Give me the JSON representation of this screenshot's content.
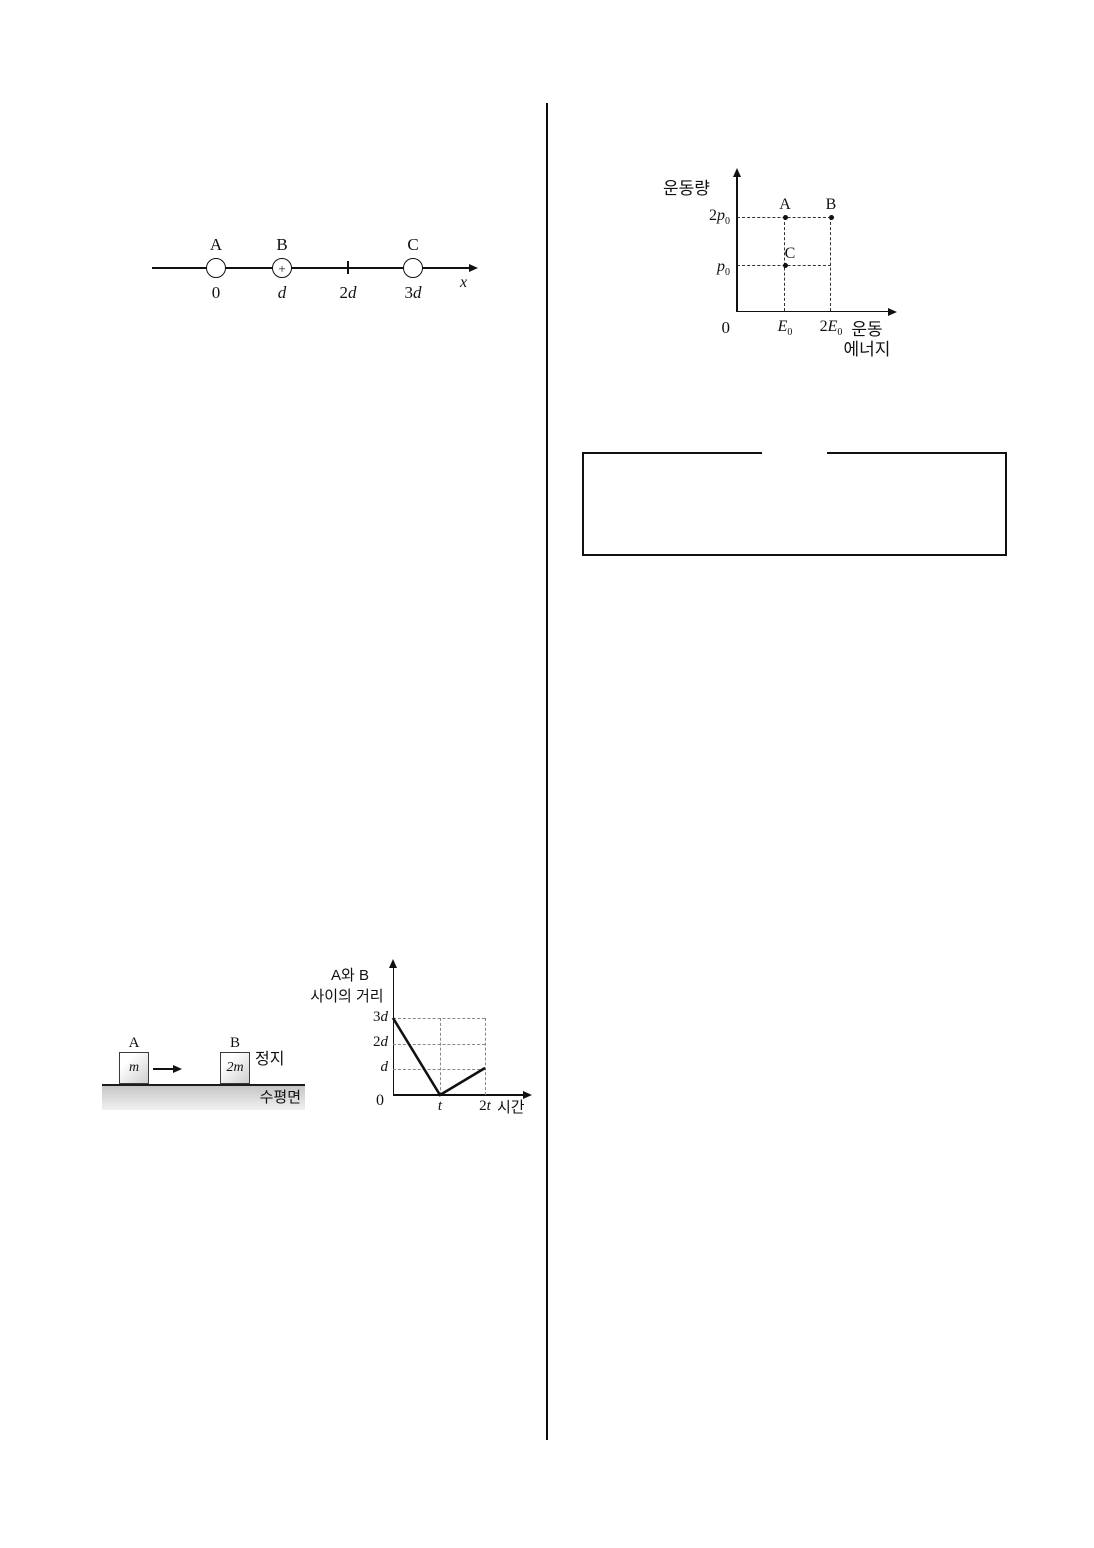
{
  "page": {
    "background": "#ffffff",
    "ink": "#111111"
  },
  "figure_charges": {
    "axis_label": "x",
    "charge_labels": [
      "A",
      "B",
      "C"
    ],
    "charge_b_sign": "+",
    "position_labels": [
      {
        "coef": "0",
        "var": ""
      },
      {
        "coef": "",
        "var": "d"
      },
      {
        "coef": "2",
        "var": "d"
      },
      {
        "coef": "3",
        "var": "d"
      }
    ]
  },
  "figure_momentum": {
    "y_axis_title": "운동량",
    "x_axis_title_line1": "운동",
    "x_axis_title_line2": "에너지",
    "origin_label": "0",
    "y_ticks": [
      {
        "coef": "2",
        "var": "p",
        "sub": "0"
      },
      {
        "coef": "",
        "var": "p",
        "sub": "0"
      }
    ],
    "x_ticks": [
      {
        "coef": "",
        "var": "E",
        "sub": "0"
      },
      {
        "coef": "2",
        "var": "E",
        "sub": "0"
      }
    ],
    "point_labels": [
      "A",
      "B",
      "C"
    ]
  },
  "figure_blocks": {
    "block_a": {
      "label": "A",
      "mass": "m"
    },
    "block_b": {
      "label": "B",
      "mass": "2m"
    },
    "rest_text": "정지",
    "surface_text": "수평면",
    "surface_color_top": "#c6c6c6",
    "surface_color_bottom": "#f0f0f0"
  },
  "figure_distance": {
    "y_axis_title_line1": "A와 B",
    "y_axis_title_line2": "사이의 거리",
    "origin_label": "0",
    "y_ticks": [
      {
        "coef": "3",
        "var": "d"
      },
      {
        "coef": "2",
        "var": "d"
      },
      {
        "coef": "",
        "var": "d"
      }
    ],
    "x_ticks": [
      {
        "coef": "",
        "var": "t"
      },
      {
        "coef": "2",
        "var": "t"
      }
    ],
    "x_axis_title": "시간"
  },
  "chart_data": [
    {
      "type": "scatter",
      "title": "momentum vs kinetic energy points A, B, C",
      "xlabel": "운동 에너지",
      "ylabel": "운동량",
      "x_tick_labels": [
        "0",
        "E0",
        "2E0"
      ],
      "y_tick_labels": [
        "p0",
        "2p0"
      ],
      "points": [
        {
          "label": "A",
          "x": "E0",
          "y": "2p0"
        },
        {
          "label": "B",
          "x": "2E0",
          "y": "2p0"
        },
        {
          "label": "C",
          "x": "E0",
          "y": "p0"
        }
      ],
      "grid": "dashed guide lines from axes to points",
      "legend": "none"
    },
    {
      "type": "line",
      "title": "distance between A and B vs time",
      "xlabel": "시간",
      "ylabel": "A와 B 사이의 거리",
      "x_tick_labels": [
        "0",
        "t",
        "2t"
      ],
      "y_tick_labels": [
        "d",
        "2d",
        "3d"
      ],
      "points": [
        {
          "x": "0",
          "y": "3d"
        },
        {
          "x": "t",
          "y": "0"
        },
        {
          "x": "2t",
          "y": "d"
        }
      ],
      "grid": "dashed guides at d, 2d, 3d and at t, 2t",
      "legend": "none"
    }
  ]
}
